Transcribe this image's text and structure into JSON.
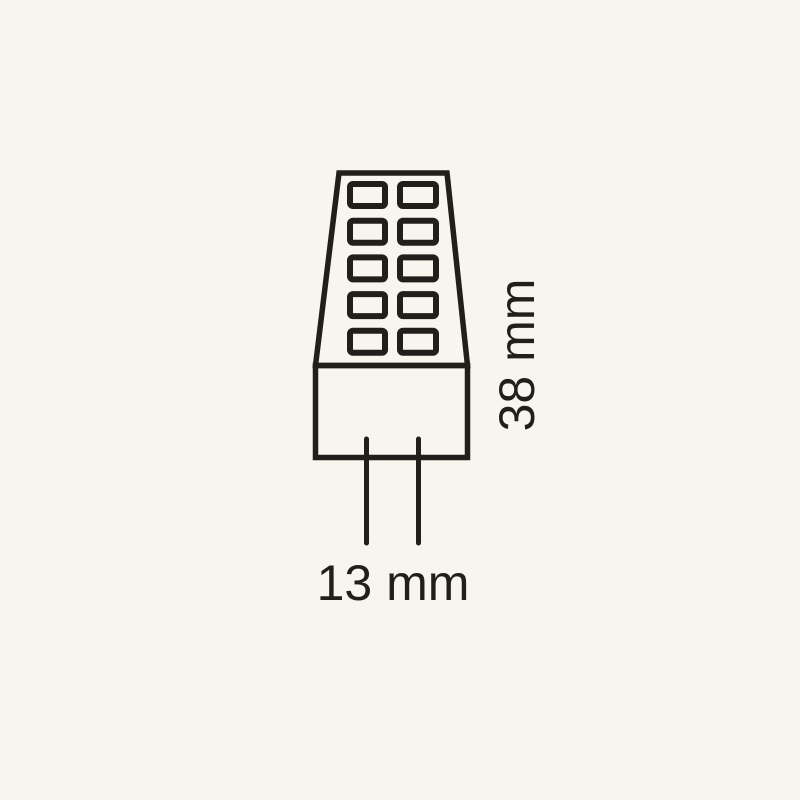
{
  "diagram": {
    "subject": "g4-led-bulb-outline-icon",
    "height_label": "38 mm",
    "width_label": "13 mm",
    "led_grid": {
      "rows": 5,
      "columns": 2
    },
    "pin_count": 2,
    "colors": {
      "background": "#f7f5ee",
      "line": "#211e1b"
    }
  }
}
